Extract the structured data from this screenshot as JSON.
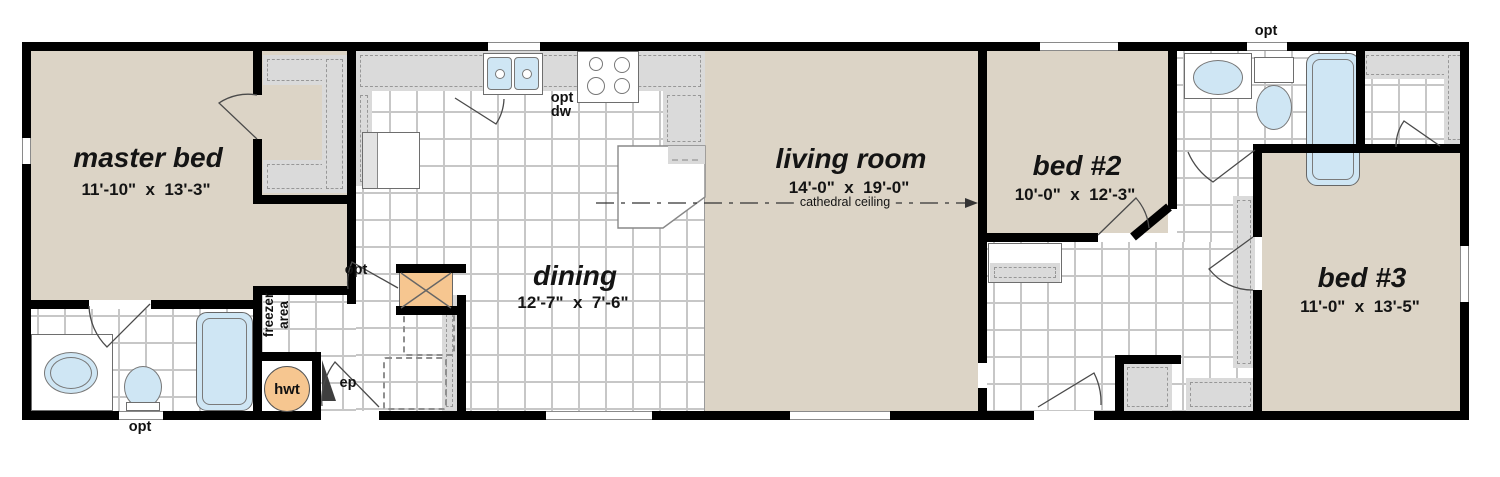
{
  "rooms": [
    {
      "name": "master bed",
      "dims": "11'-10\"  x  13'-3\""
    },
    {
      "name": "dining",
      "dims": "12'-7\"  x  7'-6\""
    },
    {
      "name": "living room",
      "dims": "14'-0\"  x  19'-0\"",
      "note": "cathedral ceiling"
    },
    {
      "name": "bed #2",
      "dims": "10'-0\"  x  12'-3\""
    },
    {
      "name": "bed #3",
      "dims": "11'-0\"  x  13'-5\""
    }
  ],
  "annotations": {
    "opt": "opt",
    "dw": "dw",
    "hwt": "hwt",
    "ep": "ep",
    "freezer_line1": "freezer",
    "freezer_line2": "area"
  },
  "colors": {
    "wall": "#000000",
    "room_fill": "#dcd4c6",
    "tile_line": "#c7c7c7",
    "counter_gray": "#dadada",
    "fixture_blue": "#cfe6f4",
    "accent_orange": "#f6c690"
  }
}
